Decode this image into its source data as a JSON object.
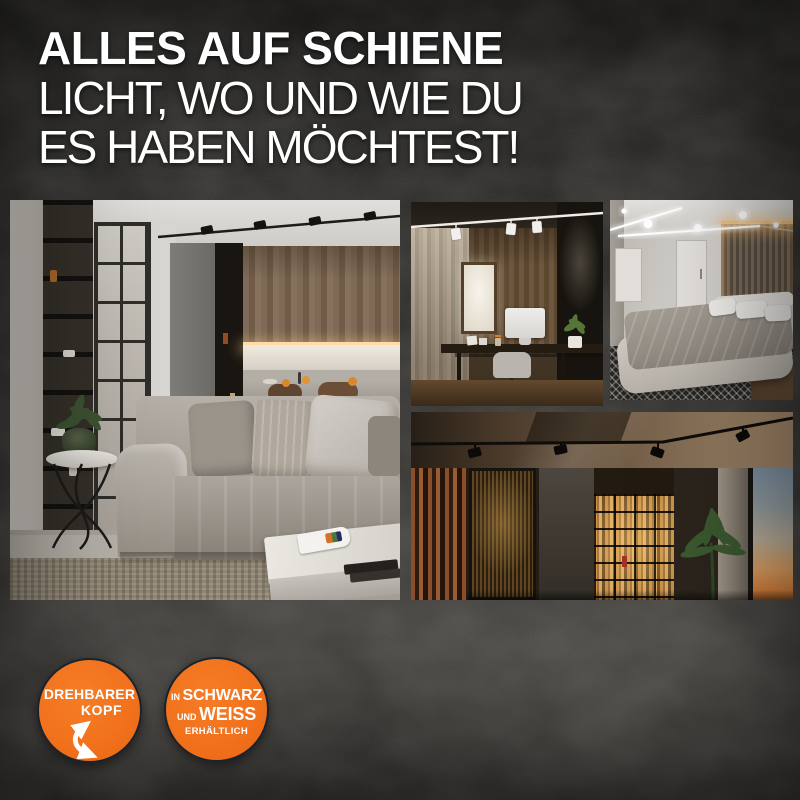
{
  "poster": {
    "headline": {
      "line1": "ALLES AUF SCHIENE",
      "line2": "LICHT, WO UND WIE DU",
      "line3": "ES HABEN MÖCHTEST!"
    },
    "badges": [
      {
        "id": "drehbarer-kopf",
        "line1": "DREHBARER",
        "line2": "KOPF",
        "icon": "rotate-arrow-icon"
      },
      {
        "id": "schwarz-weiss",
        "prefix1": "IN",
        "word1": "SCHWARZ",
        "prefix2": "UND",
        "word2": "WEISS",
        "line3": "ERHÄLTLICH"
      }
    ],
    "photos": [
      {
        "name": "living-room-track-lighting"
      },
      {
        "name": "home-office-track-lighting"
      },
      {
        "name": "bedroom-track-lighting"
      },
      {
        "name": "hallway-track-lighting-sunset-window"
      }
    ],
    "colors": {
      "accent_orange": "#f2711c",
      "headline_text": "#ffffff",
      "badge_text": "#ffffff",
      "background_dark": "#1b1a19"
    }
  }
}
